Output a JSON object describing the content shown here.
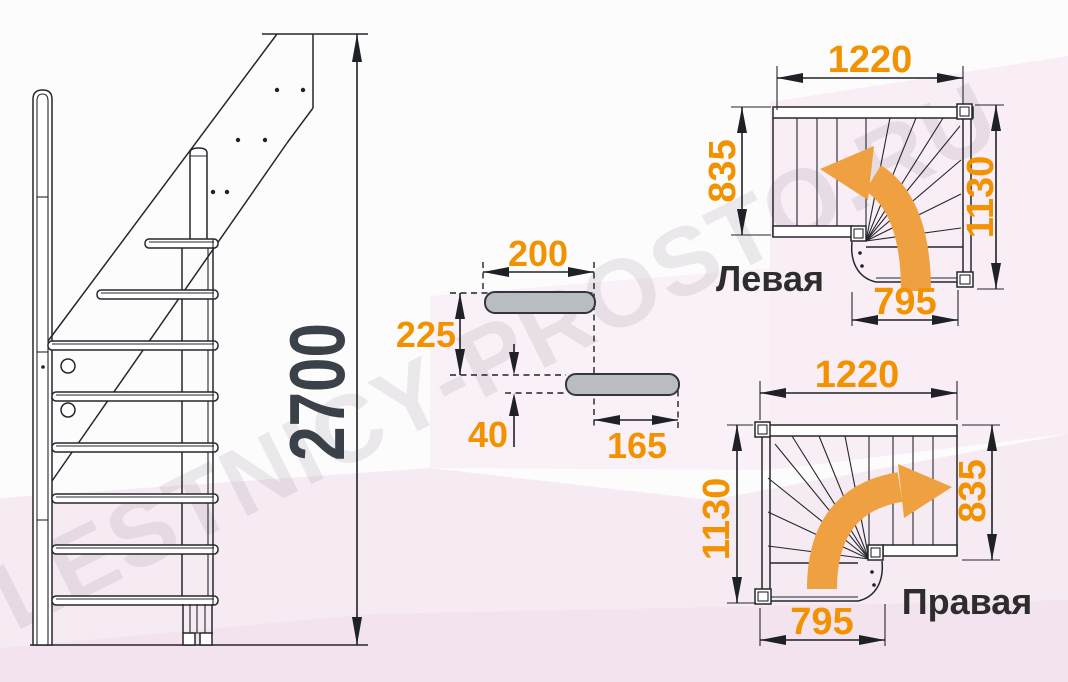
{
  "watermark": {
    "text": "LESTNICY-PROSTO.RU"
  },
  "colors": {
    "dimension_orange": "#f29200",
    "turn_arrow_orange": "#efa041",
    "drawing_line": "#24272c",
    "height_dimension_dark": "#3b4149",
    "step_fill_gray": "#b9bdc2",
    "background_pink": "#f7ebf3"
  },
  "side_view": {
    "total_height": "2700"
  },
  "step_detail": {
    "top_width": "200",
    "rise": "225",
    "thickness": "40",
    "depth": "165"
  },
  "plans": {
    "left": {
      "title": "Левая",
      "top": "1220",
      "left": "835",
      "right": "1130",
      "bottom": "795"
    },
    "right": {
      "title": "Правая",
      "top": "1220",
      "left": "1130",
      "right": "835",
      "bottom": "795"
    }
  }
}
